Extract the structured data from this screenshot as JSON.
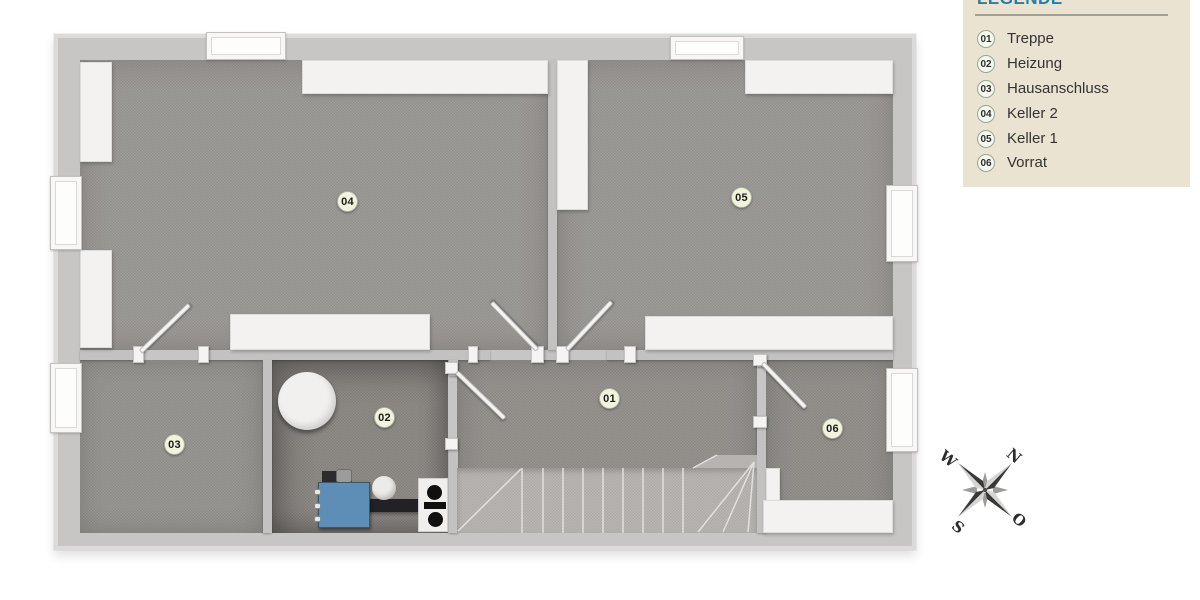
{
  "legend": {
    "title": "LEGENDE",
    "items": [
      {
        "num": "01",
        "label": "Treppe"
      },
      {
        "num": "02",
        "label": "Heizung"
      },
      {
        "num": "03",
        "label": "Hausanschluss"
      },
      {
        "num": "04",
        "label": "Keller 2"
      },
      {
        "num": "05",
        "label": "Keller 1"
      },
      {
        "num": "06",
        "label": "Vorrat"
      }
    ]
  },
  "plan": {
    "badges": [
      {
        "num": "01"
      },
      {
        "num": "02"
      },
      {
        "num": "03"
      },
      {
        "num": "04"
      },
      {
        "num": "05"
      },
      {
        "num": "06"
      }
    ]
  },
  "compass": {
    "n": "N",
    "e": "O",
    "s": "S",
    "w": "W"
  },
  "colors": {
    "legend_bg": "#ebe3d2",
    "legend_title_blue": "#2b7da0",
    "floor_gray": "#9a9793",
    "wall_gray": "#c7c6c4",
    "panel_white": "#f3f2f0",
    "boiler_blue": "#5e8db5",
    "badge_bg": "#f1f3dc"
  }
}
